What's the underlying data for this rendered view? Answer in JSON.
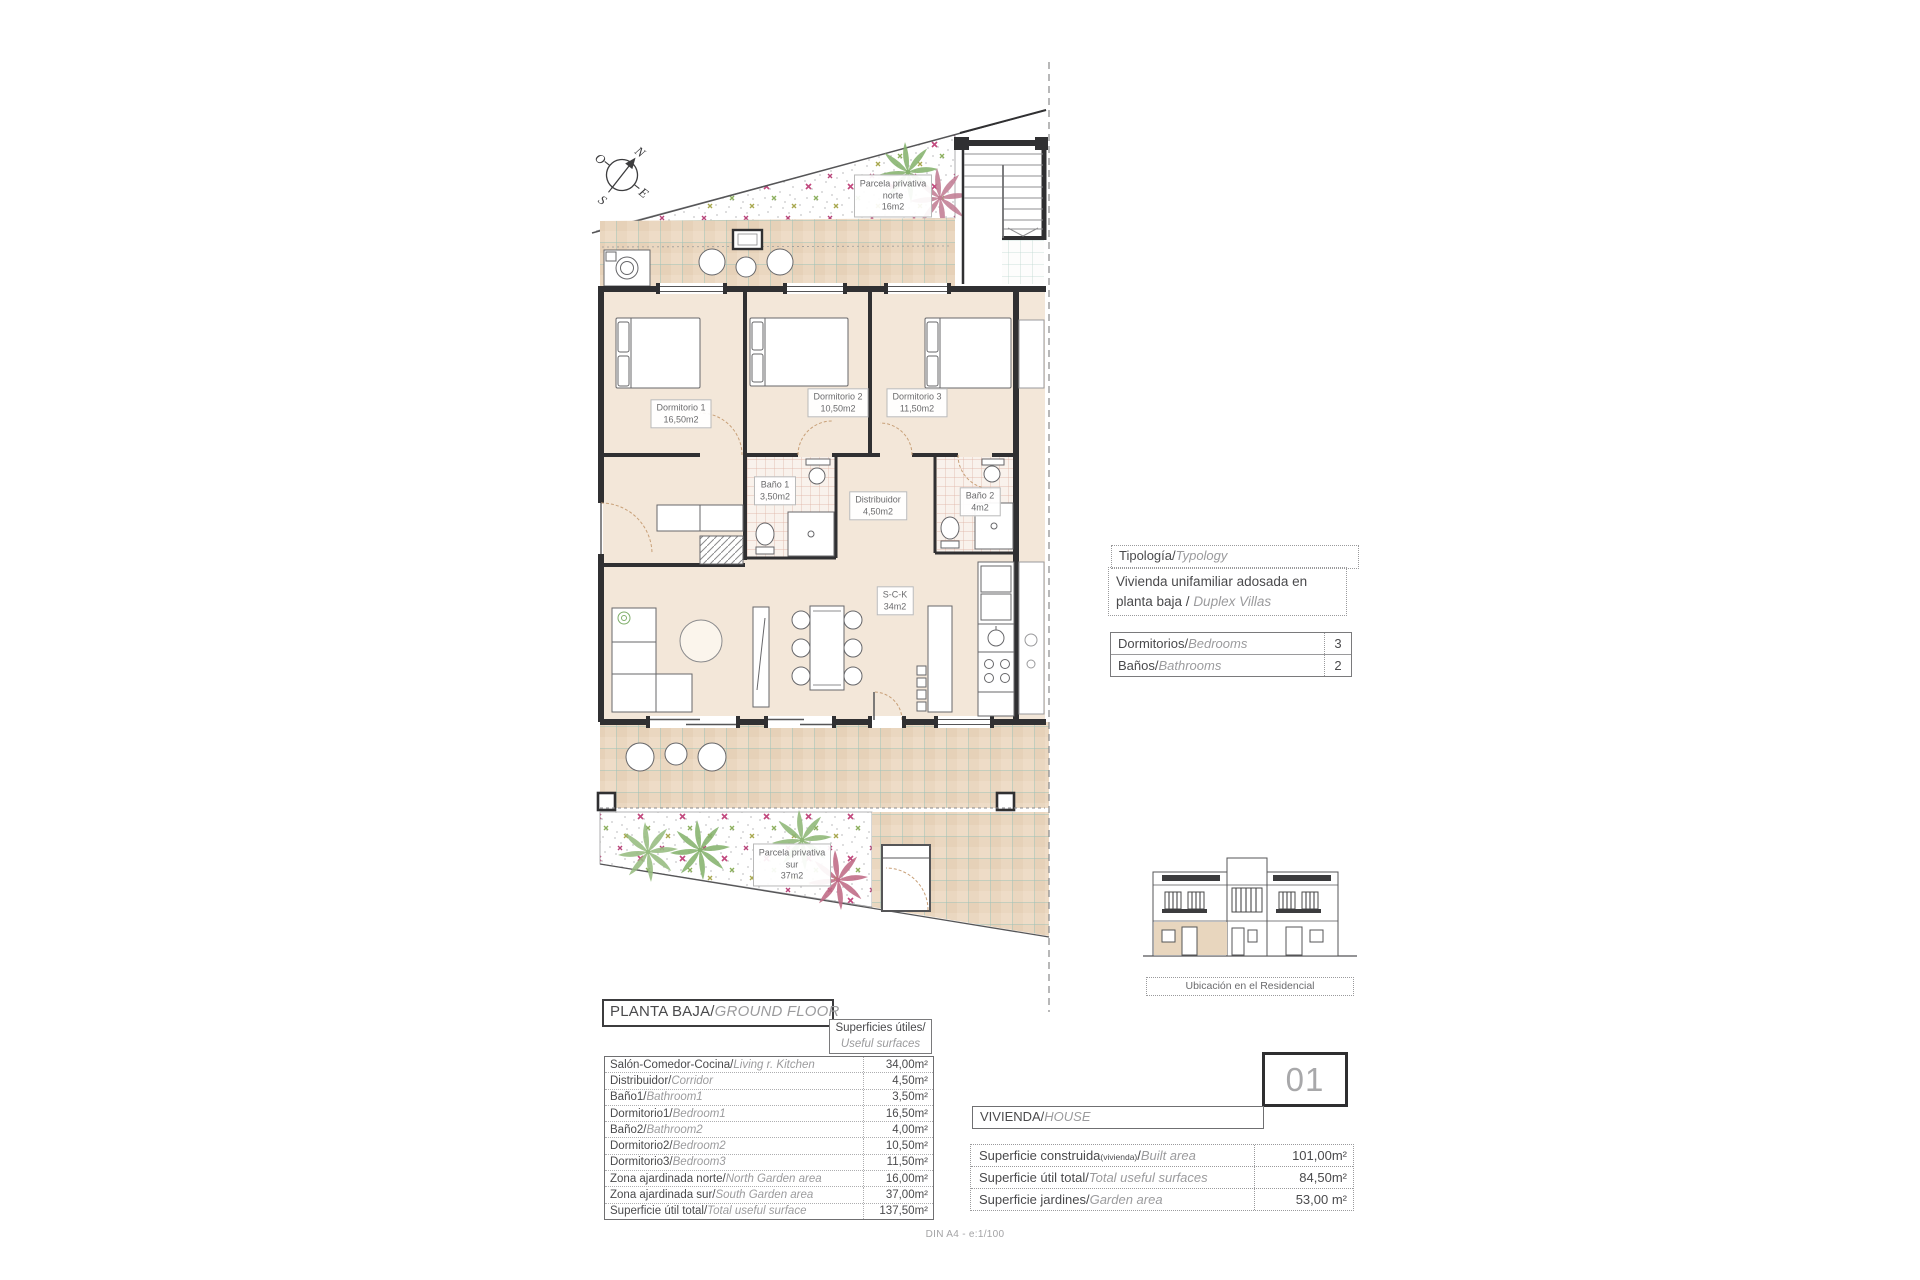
{
  "plan": {
    "dorm1": {
      "name": "Dormitorio 1",
      "area": "16,50m2"
    },
    "dorm2": {
      "name": "Dormitorio 2",
      "area": "10,50m2"
    },
    "dorm3": {
      "name": "Dormitorio 3",
      "area": "11,50m2"
    },
    "bano1": {
      "name": "Baño 1",
      "area": "3,50m2"
    },
    "bano2": {
      "name": "Baño 2",
      "area": "4m2"
    },
    "distribuidor": {
      "name": "Distribuidor",
      "area": "4,50m2"
    },
    "sck": {
      "name": "S-C-K",
      "area": "34m2"
    },
    "garden_north": {
      "name": "Parcela privativa norte",
      "area": "16m2"
    },
    "garden_south": {
      "name": "Parcela privativa sur",
      "area": "37m2"
    },
    "compass": {
      "n": "N",
      "e": "E",
      "s": "S",
      "o": "O"
    }
  },
  "typology": {
    "header_es": "Tipología/",
    "header_en": "Typology",
    "body_es": "Vivienda unifamiliar adosada en planta baja / ",
    "body_en": "Duplex Villas"
  },
  "rooms_table": {
    "rows": [
      {
        "es": "Dormitorios/",
        "en": "Bedrooms",
        "value": "3"
      },
      {
        "es": "Baños/",
        "en": "Bathrooms",
        "value": "2"
      }
    ]
  },
  "location": {
    "label": "Ubicación en el Residencial"
  },
  "floor_title": {
    "es": "PLANTA BAJA/",
    "en": "GROUND FLOOR"
  },
  "surfaces_header": {
    "es": "Superficies útiles/",
    "en": "Useful surfaces"
  },
  "surface_table": {
    "rows": [
      {
        "es": "Salón-Comedor-Cocina/",
        "en": "Living r. Kitchen",
        "value": "34,00m²"
      },
      {
        "es": "Distribuidor/",
        "en": "Corridor",
        "value": "4,50m²"
      },
      {
        "es": "Baño1/",
        "en": "Bathroom1",
        "value": "3,50m²"
      },
      {
        "es": "Dormitorio1/",
        "en": "Bedroom1",
        "value": "16,50m²"
      },
      {
        "es": "Baño2/",
        "en": "Bathroom2",
        "value": "4,00m²"
      },
      {
        "es": "Dormitorio2/",
        "en": "Bedroom2",
        "value": "10,50m²"
      },
      {
        "es": "Dormitorio3/",
        "en": "Bedroom3",
        "value": "11,50m²"
      },
      {
        "es": "Zona ajardinada norte/",
        "en": "North Garden area",
        "value": "16,00m²"
      },
      {
        "es": "Zona ajardinada sur/",
        "en": "South Garden area",
        "value": "37,00m²"
      },
      {
        "es": "Superficie útil total/",
        "en": "Total useful surface",
        "value": "137,50m²"
      }
    ]
  },
  "unit": {
    "number": "01",
    "label_es": "VIVIENDA/",
    "label_en": "HOUSE"
  },
  "unit_table": {
    "rows": [
      {
        "es": "Superficie construida",
        "small": "(vivienda)",
        "sep": "/",
        "en": "Built area",
        "value": "101,00m²"
      },
      {
        "es": "Superficie útil total",
        "small": "",
        "sep": "/",
        "en": "Total useful surfaces",
        "value": "84,50m²"
      },
      {
        "es": "Superficie jardines",
        "small": "",
        "sep": "/",
        "en": "Garden area",
        "value": "53,00 m²"
      }
    ]
  },
  "page": {
    "footer": "DIN A4 - e:1/100"
  }
}
